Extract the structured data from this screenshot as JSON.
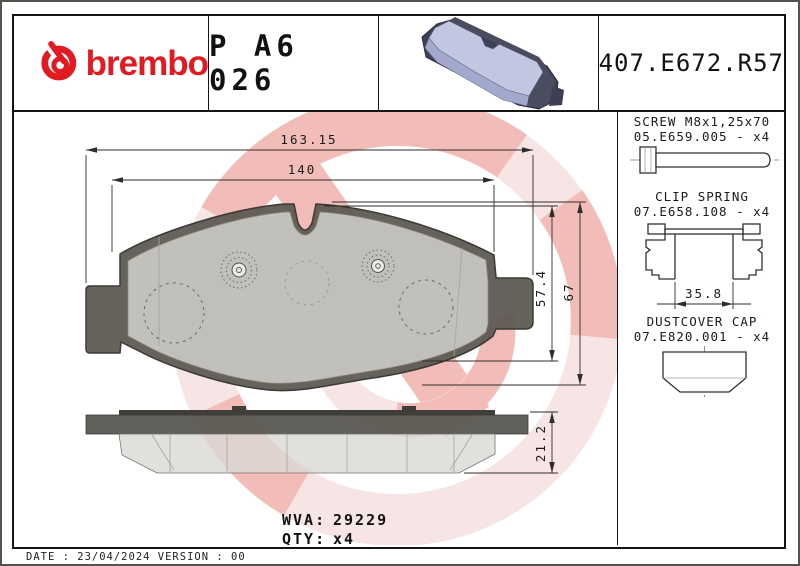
{
  "header": {
    "brand_wordmark": "brembo",
    "part_number": "P A6 026",
    "reference_code": "407.E672.R57"
  },
  "main_drawing": {
    "dim_overall_width": "163.15",
    "dim_pad_width": "140",
    "dim_pad_height": "57.4",
    "dim_overall_height": "67",
    "dim_thickness": "21.2",
    "wva_label": "WVA:",
    "wva_value": "29229",
    "qty_label": "QTY:",
    "qty_value": "x4"
  },
  "accessories": [
    {
      "title": "SCREW M8x1,25x70",
      "code": "05.E659.005 - x4"
    },
    {
      "title": "CLIP SPRING",
      "code": "07.E658.108 - x4",
      "dim_width": "35.8"
    },
    {
      "title": "DUSTCOVER CAP",
      "code": "07.E820.001 - x4"
    }
  ],
  "footer": {
    "date_line": "DATE : 23/04/2024 VERSION : 00"
  },
  "colors": {
    "brand_red": "#e01b22",
    "watermark_pink": "#f7e3e3",
    "watermark_salmon": "#f1b6b1",
    "backing_plate_gray": "#5a5751",
    "friction_gray": "#dbdad6",
    "pad3d_lavender": "#c1c6e1"
  }
}
